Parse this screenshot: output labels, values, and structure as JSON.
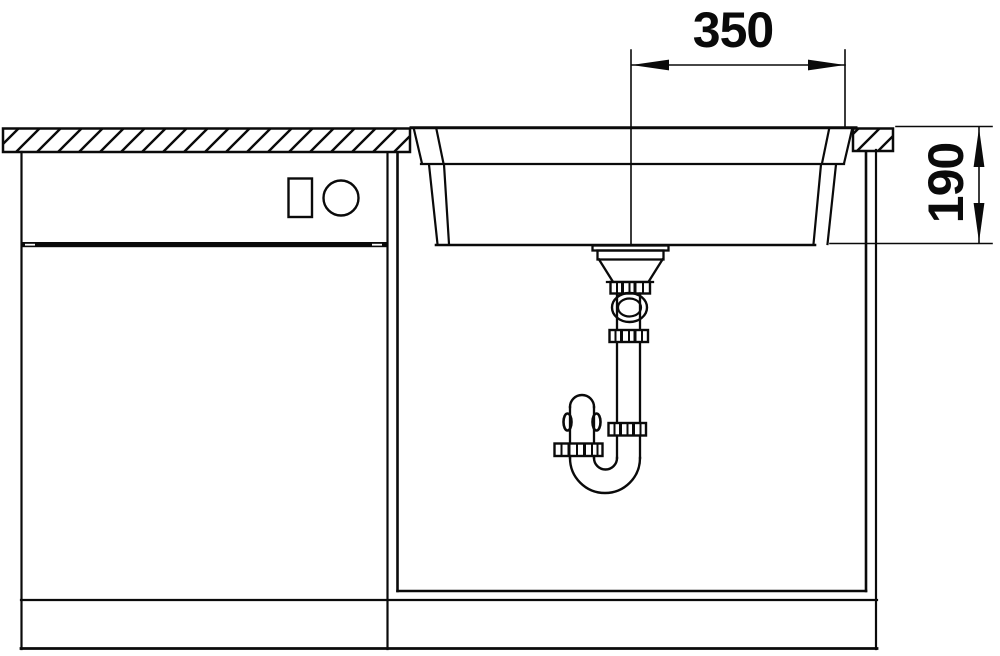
{
  "drawing": {
    "subject": "kitchen-sink-installation-cross-section",
    "background_color": "#ffffff",
    "line_color": "#0a0a0a",
    "dimensions": {
      "drain_center_width": {
        "label": "350",
        "orientation": "horizontal"
      },
      "bowl_depth": {
        "label": "190",
        "orientation": "vertical"
      }
    }
  }
}
